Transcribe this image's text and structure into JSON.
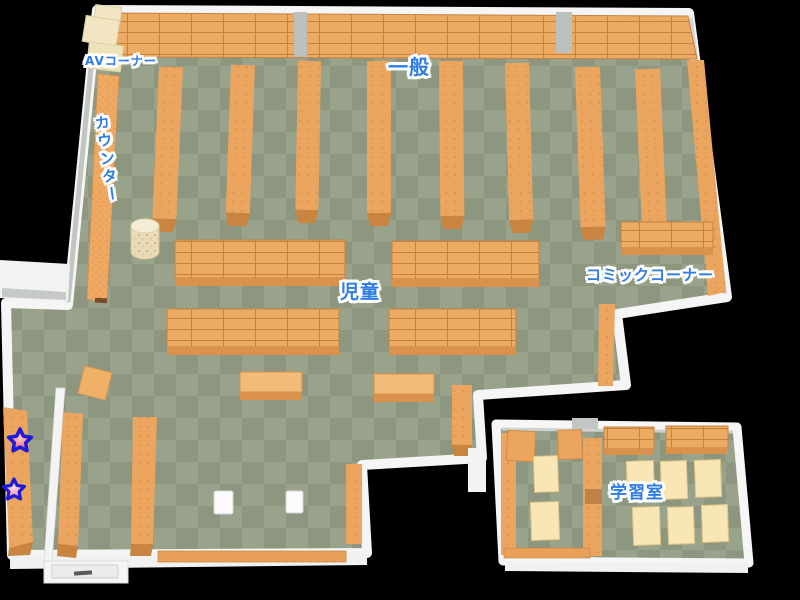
{
  "areas": {
    "av_corner": {
      "label": "AVコーナー"
    },
    "general": {
      "label": "一般"
    },
    "counter": {
      "label": "カウンター"
    },
    "children": {
      "label": "児童"
    },
    "comic_corner": {
      "label": "コミックコーナー"
    },
    "study_room": {
      "label": "学習室"
    }
  },
  "markers": {
    "stars": [
      {
        "name": "star-marker-top",
        "fill": "#ee5f76",
        "outline": "#1c1cd8"
      },
      {
        "name": "star-marker-bottom",
        "fill": "#f291a8",
        "outline": "#1c1cd8"
      }
    ]
  },
  "colors": {
    "background": "#000000",
    "wall_white": "#f5f5f5",
    "wall_gray": "#c2c6c2",
    "floor_light": "#99a38c",
    "floor_dark": "#8d977f",
    "shelf_orange": "#eca55f",
    "shelf_edge": "#c5813f",
    "shelf_side": "#d9914c",
    "shelf_cap": "#c9843f",
    "desk_cream": "#f8e7b4",
    "label_blue": "#2e7ce6"
  }
}
